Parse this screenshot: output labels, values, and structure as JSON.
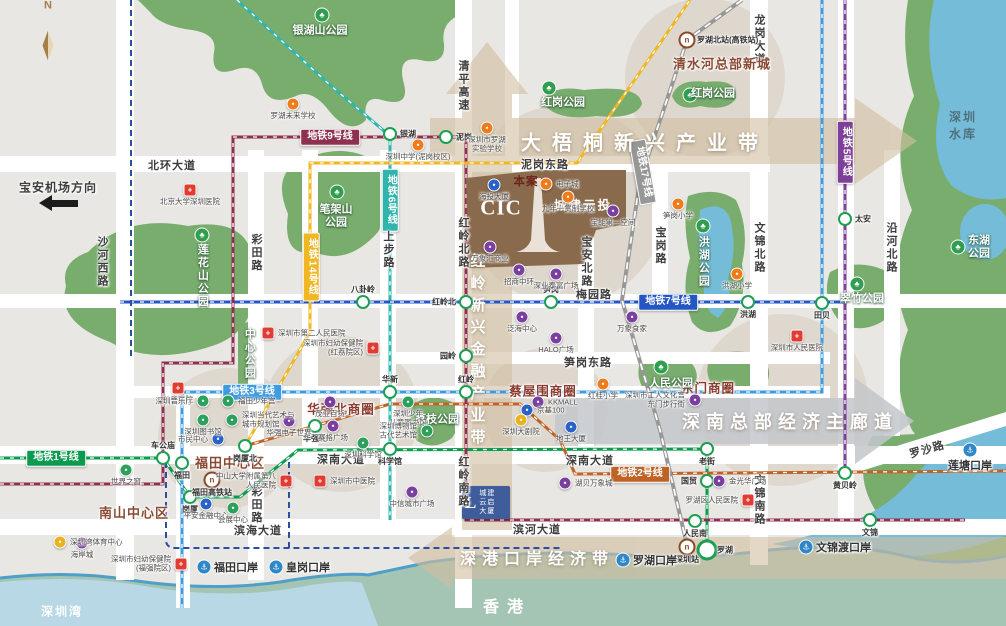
{
  "colors": {
    "bg": "#e9e7e3",
    "park": "#79ad6e",
    "park_dark": "#5f9a5c",
    "water": "#74bcd8",
    "bay": "#b9d8e5",
    "hk": "#a4c4b4",
    "coast": "#4f9fc7",
    "road": "#ffffff",
    "tan_belt": "#d2bfa2",
    "gray_belt": "#c3c7cb",
    "beige": "#d0c3b2",
    "line1": "#0a9b4e",
    "line2": "#bf6226",
    "line3": "#3f9be0",
    "line5": "#7d3f98",
    "line6": "#2fb5ac",
    "line7": "#2456c4",
    "line9": "#8e3050",
    "line14": "#f0b723",
    "line17": "#979797",
    "aux_navy": "#2b4fa0",
    "hospital": "#e23b32",
    "school": "#ef7c1b",
    "mall": "#7b3fa0",
    "building": "#2a62c8",
    "culture": "#2da05c",
    "venue": "#e8b31e",
    "rail": "#8a4a28",
    "port": "#2f86c8",
    "district_text": "#8a4a33",
    "circle_text": "#8a3b2e",
    "water_text": "#50707e"
  },
  "compass": {
    "letter": "N"
  },
  "direction_note": {
    "text": "宝安机场方向",
    "x": 58,
    "y": 187
  },
  "belts": [
    {
      "id": "dawutong",
      "text": "大梧桐新兴产业带",
      "x": 645,
      "y": 141,
      "fs": 20,
      "ls": 11,
      "vertical": false
    },
    {
      "id": "shennan",
      "text": "深南总部经济主廊道",
      "x": 790,
      "y": 421,
      "fs": 18,
      "ls": 6,
      "vertical": false
    },
    {
      "id": "shengang",
      "text": "深港口岸经济带",
      "x": 537,
      "y": 557,
      "fs": 16,
      "ls": 6,
      "vertical": false
    },
    {
      "id": "hongling",
      "text": "红岭新兴金融产业带",
      "x": 477,
      "y": 352,
      "fs": 15,
      "ls": 7,
      "vertical": true
    }
  ],
  "districts": [
    {
      "name": "南山中心区",
      "x": 134,
      "y": 512
    },
    {
      "name": "福田中心区",
      "x": 230,
      "y": 462
    },
    {
      "name": "清水河总部新城",
      "x": 722,
      "y": 63
    }
  ],
  "business_circles": [
    {
      "name": "华强北商圈",
      "x": 341,
      "y": 408
    },
    {
      "name": "蔡屋围商圈",
      "x": 543,
      "y": 390
    },
    {
      "name": "东门商圈",
      "x": 708,
      "y": 387
    }
  ],
  "parks": [
    {
      "name": "银湖山公园",
      "x": 320,
      "y": 31,
      "tree": [
        322,
        15
      ],
      "vertical": false
    },
    {
      "name": "红岗公园",
      "x": 563,
      "y": 103,
      "tree": [
        549,
        88
      ],
      "vertical": false
    },
    {
      "name": "红岗公园",
      "x": 713,
      "y": 94,
      "tree": [
        690,
        95
      ],
      "vertical": false
    },
    {
      "name": "笔架山\n公园",
      "x": 336,
      "y": 216,
      "tree": [
        337,
        192
      ],
      "vertical": false
    },
    {
      "name": "莲花山公园",
      "x": 202,
      "y": 276,
      "tree": [
        202,
        235
      ],
      "vertical": true
    },
    {
      "name": "中心公园",
      "x": 249,
      "y": 354,
      "tree": null,
      "vertical": true
    },
    {
      "name": "荔枝公园",
      "x": 437,
      "y": 420,
      "tree": null,
      "vertical": false
    },
    {
      "name": "人民公园",
      "x": 671,
      "y": 384,
      "tree": [
        661,
        367
      ],
      "vertical": false
    },
    {
      "name": "翠竹公园",
      "x": 862,
      "y": 299,
      "tree": [
        857,
        284
      ],
      "vertical": false
    },
    {
      "name": "洪湖公园",
      "x": 703,
      "y": 262,
      "tree": [
        703,
        226
      ],
      "vertical": true
    },
    {
      "name": "东湖公园",
      "x": 979,
      "y": 247,
      "tree": [
        958,
        247
      ],
      "vertical": false
    }
  ],
  "water_labels": [
    {
      "name": "深圳水库",
      "x": 968,
      "y": 125,
      "color": "#50707e"
    },
    {
      "name": "深圳湾",
      "x": 62,
      "y": 611,
      "color": "#ffffff"
    },
    {
      "name": "香港",
      "x": 507,
      "y": 605,
      "color": "#ffffff",
      "big": true
    }
  ],
  "roads": [
    {
      "name": "北环大道",
      "x": 172,
      "y": 165,
      "v": false
    },
    {
      "name": "泥岗东路",
      "x": 545,
      "y": 164,
      "v": false
    },
    {
      "name": "清平高速",
      "x": 463,
      "y": 86,
      "v": true
    },
    {
      "name": "龙岗大道",
      "x": 759,
      "y": 40,
      "v": true
    },
    {
      "name": "沙河西路",
      "x": 102,
      "y": 262,
      "v": true
    },
    {
      "name": "彩田路",
      "x": 256,
      "y": 253,
      "v": true
    },
    {
      "name": "彩田路",
      "x": 256,
      "y": 505,
      "v": true
    },
    {
      "name": "上步路",
      "x": 388,
      "y": 250,
      "v": true
    },
    {
      "name": "红岭北路",
      "x": 463,
      "y": 243,
      "v": true
    },
    {
      "name": "红岭南路",
      "x": 463,
      "y": 482,
      "v": true
    },
    {
      "name": "宝安北路",
      "x": 586,
      "y": 262,
      "v": true
    },
    {
      "name": "宝岗路",
      "x": 660,
      "y": 246,
      "v": true
    },
    {
      "name": "文锦北路",
      "x": 759,
      "y": 248,
      "v": true
    },
    {
      "name": "文锦南路",
      "x": 759,
      "y": 500,
      "v": true
    },
    {
      "name": "沿河北路",
      "x": 891,
      "y": 248,
      "v": true
    },
    {
      "name": "梅园路",
      "x": 594,
      "y": 294,
      "v": false
    },
    {
      "name": "笋岗东路",
      "x": 588,
      "y": 362,
      "v": false
    },
    {
      "name": "深南大道",
      "x": 341,
      "y": 459,
      "v": false
    },
    {
      "name": "深南大道",
      "x": 590,
      "y": 460,
      "v": false
    },
    {
      "name": "滨海大道",
      "x": 258,
      "y": 530,
      "v": false
    },
    {
      "name": "滨河大道",
      "x": 537,
      "y": 529,
      "v": false
    },
    {
      "name": "罗沙路",
      "x": 927,
      "y": 449,
      "v": false,
      "rot": -16
    }
  ],
  "metro_lines": [
    {
      "name": "地铁1号线",
      "color": "#0a9b4e",
      "style": "ticked",
      "path": "M0,458 L163,458 L190,497 L240,497 L298,450 L707,449 L707,550",
      "badge": {
        "x": 56,
        "y": 458,
        "rot": 0,
        "vertical": false
      }
    },
    {
      "name": "地铁2号线",
      "color": "#bf6226",
      "style": "ticked",
      "path": "M245,446 L390,404 L520,404 L560,440 L575,474 L1006,471",
      "badge": {
        "x": 640,
        "y": 474,
        "rot": 0,
        "vertical": false
      }
    },
    {
      "name": "地铁3号线",
      "color": "#3f9be0",
      "style": "ticked",
      "path": "M182,608 L182,392 L822,392 L822,0",
      "badge": {
        "x": 252,
        "y": 392,
        "rot": 0,
        "vertical": false
      }
    },
    {
      "name": "地铁5号线",
      "color": "#7d3f98",
      "style": "ticked",
      "path": "M845,0 L845,473",
      "badge": {
        "x": 845,
        "y": 152,
        "rot": 0,
        "vertical": true
      }
    },
    {
      "name": "地铁6号线",
      "color": "#2fb5ac",
      "style": "ticked",
      "path": "M237,0 L330,85 L390,136 L390,520",
      "badge": {
        "x": 390,
        "y": 200,
        "rot": 0,
        "vertical": true
      }
    },
    {
      "name": "地铁7号线",
      "color": "#2456c4",
      "style": "ticked",
      "path": "M120,302 L845,302",
      "badge": {
        "x": 668,
        "y": 302,
        "rot": 0,
        "vertical": false
      }
    },
    {
      "name": "地铁9号线",
      "color": "#8e3050",
      "style": "ticked",
      "path": "M0,484 L163,484 L163,363 L233,363 L233,137 L466,137 L466,520 L965,520",
      "badge": {
        "x": 330,
        "y": 137,
        "rot": 0,
        "vertical": false
      }
    },
    {
      "name": "地铁14号线",
      "color": "#f0b723",
      "style": "ticked",
      "path": "M245,446 L310,332 L310,163 L577,163 L690,0",
      "badge": {
        "x": 311,
        "y": 267,
        "rot": 0,
        "vertical": true
      }
    },
    {
      "name": "地铁17号线",
      "color": "#979797",
      "style": "railway",
      "path": "M742,0 L687,40 L640,180 L622,300 L660,430 L687,545",
      "badge": {
        "x": 643,
        "y": 172,
        "rot": 80,
        "vertical": false
      }
    },
    {
      "name": "",
      "color": "#2b4fa0",
      "style": "dash",
      "path": "M131,0 L131,360",
      "badge": null
    },
    {
      "name": "",
      "color": "#2b4fa0",
      "style": "dash",
      "path": "M166,462 L166,540 Q166,548 176,548 L560,548",
      "badge": null
    },
    {
      "name": "",
      "color": "#2b4fa0",
      "style": "dash",
      "path": "M289,462 L289,552",
      "badge": null
    }
  ],
  "stations": [
    {
      "name": "银湖",
      "x": 390,
      "y": 134,
      "s": "r"
    },
    {
      "name": "泥岗",
      "x": 446,
      "y": 137,
      "s": "r"
    },
    {
      "name": "八卦岭",
      "x": 363,
      "y": 302,
      "s": "t"
    },
    {
      "name": "红岭北",
      "x": 466,
      "y": 302,
      "s": "l"
    },
    {
      "name": "笋岗",
      "x": 551,
      "y": 302,
      "s": "t"
    },
    {
      "name": "洪湖",
      "x": 748,
      "y": 302,
      "s": "b"
    },
    {
      "name": "田贝",
      "x": 822,
      "y": 303,
      "s": "b"
    },
    {
      "name": "太安",
      "x": 845,
      "y": 219,
      "s": "r"
    },
    {
      "name": "园岭",
      "x": 466,
      "y": 356,
      "s": "l"
    },
    {
      "name": "红岭",
      "x": 466,
      "y": 392,
      "s": "t"
    },
    {
      "name": "华新",
      "x": 390,
      "y": 392,
      "s": "t"
    },
    {
      "name": "华强北",
      "x": 315,
      "y": 426,
      "s": "b"
    },
    {
      "name": "科学馆",
      "x": 390,
      "y": 449,
      "s": "b"
    },
    {
      "name": "岗厦北",
      "x": 245,
      "y": 446,
      "s": "b"
    },
    {
      "name": "福田",
      "x": 182,
      "y": 463,
      "s": "b"
    },
    {
      "name": "车公庙",
      "x": 163,
      "y": 458,
      "s": "t"
    },
    {
      "name": "岗厦",
      "x": 190,
      "y": 497,
      "s": "b"
    },
    {
      "name": "老街",
      "x": 707,
      "y": 449,
      "s": "b"
    },
    {
      "name": "国贸",
      "x": 707,
      "y": 481,
      "s": "l"
    },
    {
      "name": "人民南",
      "x": 695,
      "y": 521,
      "s": "b"
    },
    {
      "name": "文锦",
      "x": 870,
      "y": 520,
      "s": "b"
    },
    {
      "name": "罗湖",
      "x": 707,
      "y": 550,
      "s": "r",
      "big": true
    },
    {
      "name": "黄贝岭",
      "x": 845,
      "y": 473,
      "s": "b"
    }
  ],
  "rail_stations": [
    {
      "name": "罗湖北站(高铁站)",
      "x": 687,
      "y": 40,
      "s": "r"
    },
    {
      "name": "福田高铁站",
      "x": 212,
      "y": 480,
      "s": "b"
    },
    {
      "name": "深圳站",
      "x": 687,
      "y": 547,
      "s": "b"
    }
  ],
  "ports": [
    {
      "name": "福田口岸",
      "x": 204,
      "y": 567,
      "s": "r"
    },
    {
      "name": "皇岗口岸",
      "x": 276,
      "y": 567,
      "s": "r"
    },
    {
      "name": "罗湖口岸",
      "x": 623,
      "y": 560,
      "s": "r"
    },
    {
      "name": "文锦渡口岸",
      "x": 806,
      "y": 547,
      "s": "r"
    },
    {
      "name": "莲塘口岸",
      "x": 970,
      "y": 450,
      "s": "b"
    }
  ],
  "pois": [
    {
      "name": "北京大学深圳医院",
      "type": "hospital",
      "x": 190,
      "y": 190,
      "s": "b"
    },
    {
      "name": "深圳市第二人民医院",
      "type": "hospital",
      "x": 268,
      "y": 333,
      "s": "r"
    },
    {
      "name": "深圳市妇幼保健院\n(红荔院区)",
      "type": "hospital",
      "x": 373,
      "y": 348,
      "s": "l"
    },
    {
      "name": "儿童医院",
      "type": "hospital",
      "x": 178,
      "y": 388,
      "s": "b"
    },
    {
      "name": "中山大学附属第八\n人民医院",
      "type": "hospital",
      "x": 286,
      "y": 481,
      "s": "l"
    },
    {
      "name": "深圳市中医院",
      "type": "hospital",
      "x": 320,
      "y": 481,
      "s": "r"
    },
    {
      "name": "深圳市人民医院",
      "type": "hospital",
      "x": 797,
      "y": 336,
      "s": "b"
    },
    {
      "name": "罗湖区人民医院",
      "type": "hospital",
      "x": 748,
      "y": 500,
      "s": "l"
    },
    {
      "name": "深圳市妇幼保健院\n(福强院区)",
      "type": "hospital",
      "x": 181,
      "y": 564,
      "s": "l"
    },
    {
      "name": "罗湖未来学校",
      "type": "school",
      "x": 293,
      "y": 104,
      "s": "b"
    },
    {
      "name": "深圳市罗湖\n实验学校",
      "type": "school",
      "x": 487,
      "y": 128,
      "s": "b"
    },
    {
      "name": "深圳中学(泥岗校区)",
      "type": "school",
      "x": 418,
      "y": 145,
      "s": "b"
    },
    {
      "name": "九年一贯制学校",
      "type": "school",
      "x": 568,
      "y": 197,
      "s": "b"
    },
    {
      "name": "电子城",
      "type": "mall",
      "color": "#ef7c1b",
      "x": 546,
      "y": 184,
      "s": "r"
    },
    {
      "name": "笋岗小学",
      "type": "school",
      "x": 678,
      "y": 204,
      "s": "b"
    },
    {
      "name": "洪湖小学",
      "type": "school",
      "x": 737,
      "y": 274,
      "s": "b"
    },
    {
      "name": "红桂小学",
      "type": "school",
      "x": 603,
      "y": 384,
      "s": "b"
    },
    {
      "name": "万象汇商业",
      "type": "mall",
      "x": 490,
      "y": 247,
      "s": "b"
    },
    {
      "name": "招商中环",
      "type": "mall",
      "x": 519,
      "y": 270,
      "s": "b"
    },
    {
      "name": "深业泰富广场",
      "type": "mall",
      "x": 556,
      "y": 274,
      "s": "b"
    },
    {
      "name": "泛海中心",
      "type": "mall",
      "x": 522,
      "y": 317,
      "s": "b"
    },
    {
      "name": "宝能第一空间",
      "type": "mall",
      "x": 613,
      "y": 211,
      "s": "b"
    },
    {
      "name": "万象食家",
      "type": "mall",
      "x": 632,
      "y": 317,
      "s": "b"
    },
    {
      "name": "HALO广场",
      "type": "mall",
      "x": 556,
      "y": 338,
      "s": "b"
    },
    {
      "name": "茂业百货",
      "type": "mall",
      "x": 330,
      "y": 402,
      "s": "b"
    },
    {
      "name": "华强电子世界",
      "type": "mall",
      "x": 289,
      "y": 421,
      "s": "b"
    },
    {
      "name": "赛格广场",
      "type": "mall",
      "x": 333,
      "y": 426,
      "s": "b"
    },
    {
      "name": "KKMALL",
      "type": "mall",
      "x": 538,
      "y": 402,
      "s": "r"
    },
    {
      "name": "金光华广场",
      "type": "mall",
      "x": 719,
      "y": 481,
      "s": "r"
    },
    {
      "name": "中信城市广场",
      "type": "mall",
      "x": 412,
      "y": 492,
      "s": "b"
    },
    {
      "name": "湖贝万象城",
      "type": "mall",
      "x": 565,
      "y": 483,
      "s": "r"
    },
    {
      "name": "深圳市工人文化宫\n东门步行街",
      "type": "mall",
      "x": 695,
      "y": 400,
      "s": "l"
    },
    {
      "name": "海岸城",
      "type": "mall",
      "x": 82,
      "y": 543,
      "s": "b"
    },
    {
      "name": "海投大厦",
      "type": "building",
      "x": 494,
      "y": 185,
      "s": "b"
    },
    {
      "name": "市民中心",
      "type": "building",
      "x": 218,
      "y": 439,
      "s": "l"
    },
    {
      "name": "平安金融中心",
      "type": "building",
      "x": 206,
      "y": 504,
      "s": "b"
    },
    {
      "name": "京基100",
      "type": "building",
      "x": 527,
      "y": 410,
      "s": "r"
    },
    {
      "name": "地王大厦",
      "type": "building",
      "x": 571,
      "y": 427,
      "s": "b"
    },
    {
      "name": "世界之窗",
      "type": "culture",
      "x": 126,
      "y": 470,
      "s": "b"
    },
    {
      "name": "深圳音乐厅",
      "type": "culture",
      "x": 203,
      "y": 401,
      "s": "l"
    },
    {
      "name": "深圳图书馆",
      "type": "culture",
      "x": 203,
      "y": 420,
      "s": "b"
    },
    {
      "name": "福田少年宫",
      "type": "culture",
      "x": 228,
      "y": 401,
      "s": "r"
    },
    {
      "name": "深圳当代艺术与\n城市规划馆",
      "type": "culture",
      "x": 232,
      "y": 420,
      "s": "r"
    },
    {
      "name": "深圳少年\n儿童图书馆",
      "type": "culture",
      "x": 408,
      "y": 402,
      "s": "b"
    },
    {
      "name": "深圳博物馆\n古代艺术馆",
      "type": "culture",
      "x": 427,
      "y": 431,
      "s": "l"
    },
    {
      "name": "会展中心",
      "type": "culture",
      "x": 233,
      "y": 508,
      "s": "b"
    },
    {
      "name": "深圳科学馆",
      "type": "culture",
      "x": 363,
      "y": 443,
      "s": "b"
    },
    {
      "name": "深圳大剧院",
      "type": "venue",
      "x": 521,
      "y": 420,
      "s": "b"
    },
    {
      "name": "深圳湾体育中心",
      "type": "venue",
      "x": 60,
      "y": 542,
      "s": "r"
    }
  ],
  "project": {
    "marker_label": "本案",
    "star": "★",
    "logo_text": "CIC",
    "brand": "城建云投",
    "tower2_logo": "L",
    "tower2_name": "城建\n云启\n大厦"
  },
  "icon_glyphs": {
    "hospital": "+",
    "generic": "•",
    "tree": "♣",
    "port": "⚓",
    "rail": "n"
  }
}
